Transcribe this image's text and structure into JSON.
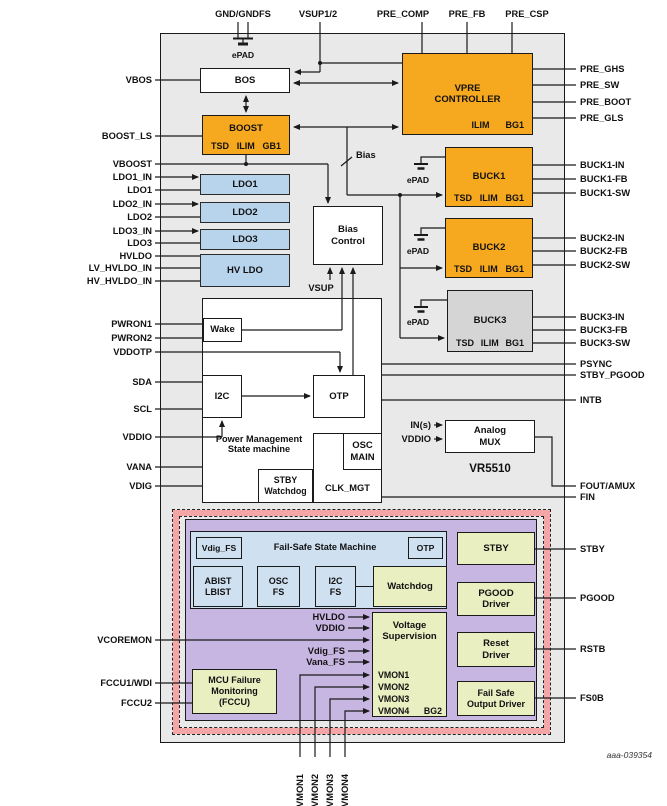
{
  "figure_id": "aaa-039354",
  "chip_name": "VR5510",
  "colors": {
    "orange": "#f6a81f",
    "ldo_blue": "#b8d3ec",
    "failsafe_blue": "#cfe0f1",
    "yellow_green": "#eaefc2",
    "purple": "#c8b6e2",
    "pink_band": "#f4a6a6",
    "chip_gray": "#e9e9e9",
    "buck3_gray": "#d5d5d5"
  },
  "top_pins": {
    "gnd": "GND/GNDFS",
    "vsup12": "VSUP1/2",
    "pre_comp": "PRE_COMP",
    "pre_fb": "PRE_FB",
    "pre_csp": "PRE_CSP"
  },
  "left_pins": {
    "vbos": "VBOS",
    "boost_ls": "BOOST_LS",
    "vboost": "VBOOST",
    "ldo1_in": "LDO1_IN",
    "ldo1": "LDO1",
    "ldo2_in": "LDO2_IN",
    "ldo2": "LDO2",
    "ldo3_in": "LDO3_IN",
    "ldo3": "LDO3",
    "hvldo": "HVLDO",
    "lv_hvldo_in": "LV_HVLDO_IN",
    "hv_hvldo_in": "HV_HVLDO_IN",
    "pwron1": "PWRON1",
    "pwron2": "PWRON2",
    "vddotp": "VDDOTP",
    "sda": "SDA",
    "scl": "SCL",
    "vddio": "VDDIO",
    "vana": "VANA",
    "vdig": "VDIG",
    "vcoremon": "VCOREMON",
    "fccu1_wdi": "FCCU1/WDI",
    "fccu2": "FCCU2"
  },
  "right_pins": {
    "pre_ghs": "PRE_GHS",
    "pre_sw": "PRE_SW",
    "pre_boot": "PRE_BOOT",
    "pre_gls": "PRE_GLS",
    "buck1_in": "BUCK1-IN",
    "buck1_fb": "BUCK1-FB",
    "buck1_sw": "BUCK1-SW",
    "buck2_in": "BUCK2-IN",
    "buck2_fb": "BUCK2-FB",
    "buck2_sw": "BUCK2-SW",
    "buck3_in": "BUCK3-IN",
    "buck3_fb": "BUCK3-FB",
    "buck3_sw": "BUCK3-SW",
    "psync": "PSYNC",
    "stby_pgood": "STBY_PGOOD",
    "intb": "INTB",
    "fout_amux": "FOUT/AMUX",
    "fin": "FIN",
    "stby": "STBY",
    "pgood": "PGOOD",
    "rstb": "RSTB",
    "fs0b": "FS0B"
  },
  "bottom_pins": {
    "vmon1": "VMON1",
    "vmon2": "VMON2",
    "vmon3": "VMON3",
    "vmon4": "VMON4"
  },
  "blocks": {
    "bos": "BOS",
    "boost": {
      "title": "BOOST",
      "tsd": "TSD",
      "ilim": "ILIM",
      "gb1": "GB1"
    },
    "vpre": {
      "title": "VPRE\nCONTROLLER",
      "ilim": "ILIM",
      "bg1": "BG1"
    },
    "ldo1": "LDO1",
    "ldo2": "LDO2",
    "ldo3": "LDO3",
    "hv_ldo": "HV LDO",
    "bias_control": "Bias\nControl",
    "buck1": {
      "title": "BUCK1",
      "tsd": "TSD",
      "ilim": "ILIM",
      "bg1": "BG1"
    },
    "buck2": {
      "title": "BUCK2",
      "tsd": "TSD",
      "ilim": "ILIM",
      "bg1": "BG1"
    },
    "buck3": {
      "title": "BUCK3",
      "tsd": "TSD",
      "ilim": "ILIM",
      "bg1": "BG1"
    },
    "pmsm": "Power Management\nState machine",
    "wake": "Wake",
    "i2c": "I2C",
    "otp": "OTP",
    "stby_watchdog": "STBY\nWatchdog",
    "osc_main": "OSC\nMAIN",
    "clk_mgt": "CLK_MGT",
    "analog_mux": "Analog\nMUX"
  },
  "failsafe": {
    "vdig_fs": "Vdig_FS",
    "state_machine": "Fail-Safe State Machine",
    "otp": "OTP",
    "abist_lbist": "ABIST\nLBIST",
    "osc_fs": "OSC\nFS",
    "i2c_fs": "I2C\nFS",
    "watchdog": "Watchdog",
    "stby": "STBY",
    "pgood_driver": "PGOOD\nDriver",
    "reset_driver": "Reset\nDriver",
    "fs_output_driver": "Fail Safe\nOutput Driver",
    "voltage_supervision": "Voltage\nSupervision",
    "vmon1": "VMON1",
    "vmon2": "VMON2",
    "vmon3": "VMON3",
    "vmon4": "VMON4",
    "bg2": "BG2",
    "mcu": "MCU Failure\nMonitoring\n(FCCU)",
    "in_hvldo": "HVLDO",
    "in_vddio": "VDDIO",
    "in_vdig_fs": "Vdig_FS",
    "in_vana_fs": "Vana_FS"
  },
  "annotations": {
    "epad": "ePAD",
    "vsup": "VSUP",
    "bias": "Bias",
    "ins": "IN(s)",
    "vddio_mux": "VDDIO"
  }
}
